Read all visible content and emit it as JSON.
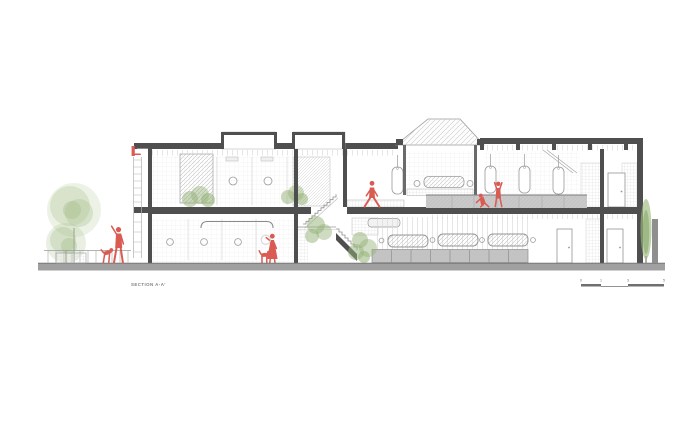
{
  "drawing": {
    "title": "SECTION A-A'",
    "scale_bar": {
      "labels": [
        "0",
        "1",
        "3",
        "5"
      ]
    },
    "colors": {
      "figure_red": "#d95b52",
      "tree_green": "#a4bd89",
      "plant_green": "#94b277",
      "cypress_green": "#9cba7c",
      "ground_gray": "#a0a0a0",
      "structure_dark": "#4f4f4f",
      "mid_gray": "#8f8f8f",
      "railing_gray": "#c9c9c9",
      "cabinet_gray": "#c3c3c3",
      "outline_gray": "#9a9a9a",
      "text_gray": "#808080",
      "background": "#ffffff"
    },
    "people": [
      "man-with-raised-arm",
      "woman-with-hoop",
      "walking-person",
      "boxing-person-lunging",
      "boxing-person-standing"
    ],
    "animals": [
      "jumping-dog",
      "standing-dog"
    ],
    "equipment": [
      "basketball-hoop",
      "punching-bags",
      "wall-barre",
      "courtyard-bench",
      "sofa",
      "dining-tables",
      "cabinets",
      "stairs",
      "doors"
    ],
    "vegetation": [
      "large-tree",
      "small-tree",
      "cypress-tree",
      "planter-shrubs",
      "indoor-plants"
    ]
  }
}
